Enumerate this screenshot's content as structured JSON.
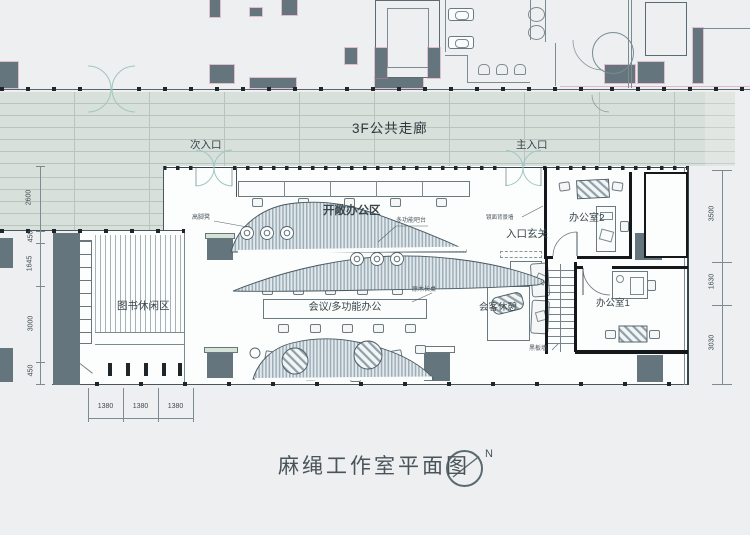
{
  "title": {
    "text": "麻绳工作室平面图"
  },
  "compass": {
    "north_label": "N"
  },
  "corridor": {
    "label": "3F公共走廊"
  },
  "entrances": {
    "secondary_label": "次入口",
    "main_label": "主入口"
  },
  "zones": {
    "open_office": "开敞办公区",
    "entry_foyer": "入口玄关",
    "office_2": "办公室2",
    "office_1": "办公室1",
    "book_leisure": "图书休闲区",
    "meeting_multi": "会议/多功能办公",
    "reception_rest": "会客休憩"
  },
  "callouts": {
    "bar_stools": "高脚凳",
    "multi_bar": "多功能吧台",
    "mirror_wall": "镜面背景墙",
    "wood_long_table": "原木长桌",
    "blackboard_wall": "黑板墙"
  },
  "dimensions": {
    "left": [
      "2600",
      "450",
      "1645",
      "3000",
      "450"
    ],
    "bottom": [
      "1380",
      "1380",
      "1380"
    ],
    "right": [
      "3500",
      "1630",
      "3030"
    ]
  },
  "colors": {
    "wall_fill": "#64757d",
    "corridor_floor": "#d8e0db",
    "accent_pink": "#cf8aa6",
    "hatch": "#9cafb9"
  }
}
